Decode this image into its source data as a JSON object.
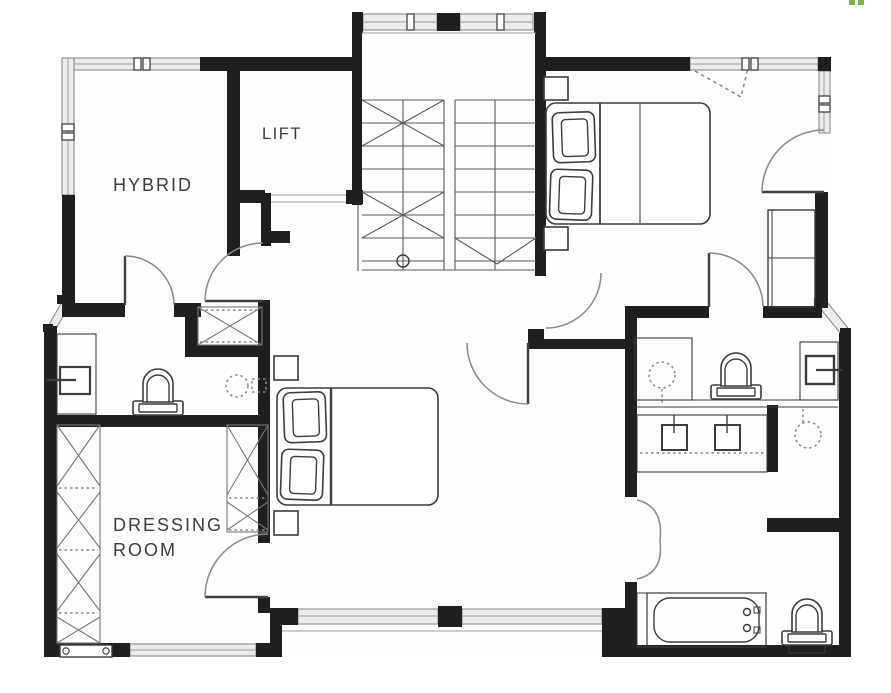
{
  "page": {
    "type": "architectural-floor-plan"
  },
  "labels": {
    "hybrid": "HYBRID",
    "lift": "LIFT",
    "dressing_line1": "DRESSING",
    "dressing_line2": "ROOM"
  },
  "fixtures": [
    "staircase",
    "lift",
    "double-bed",
    "double-bed",
    "toilet",
    "toilet",
    "toilet",
    "washbasin",
    "wall-cistern",
    "double-vanity-sinks",
    "bathtub",
    "shower-head",
    "shower-head",
    "wardrobe",
    "wardrobe",
    "wardrobe",
    "bedside-table",
    "radiator",
    "window",
    "door-swing"
  ],
  "colors": {
    "wall": "#1f1f1f",
    "line": "#4a4a4a",
    "window": "#8c8c8c",
    "text": "#3d3d3d",
    "accent_green": "#7cb342",
    "floor": "#fcfcfc"
  }
}
